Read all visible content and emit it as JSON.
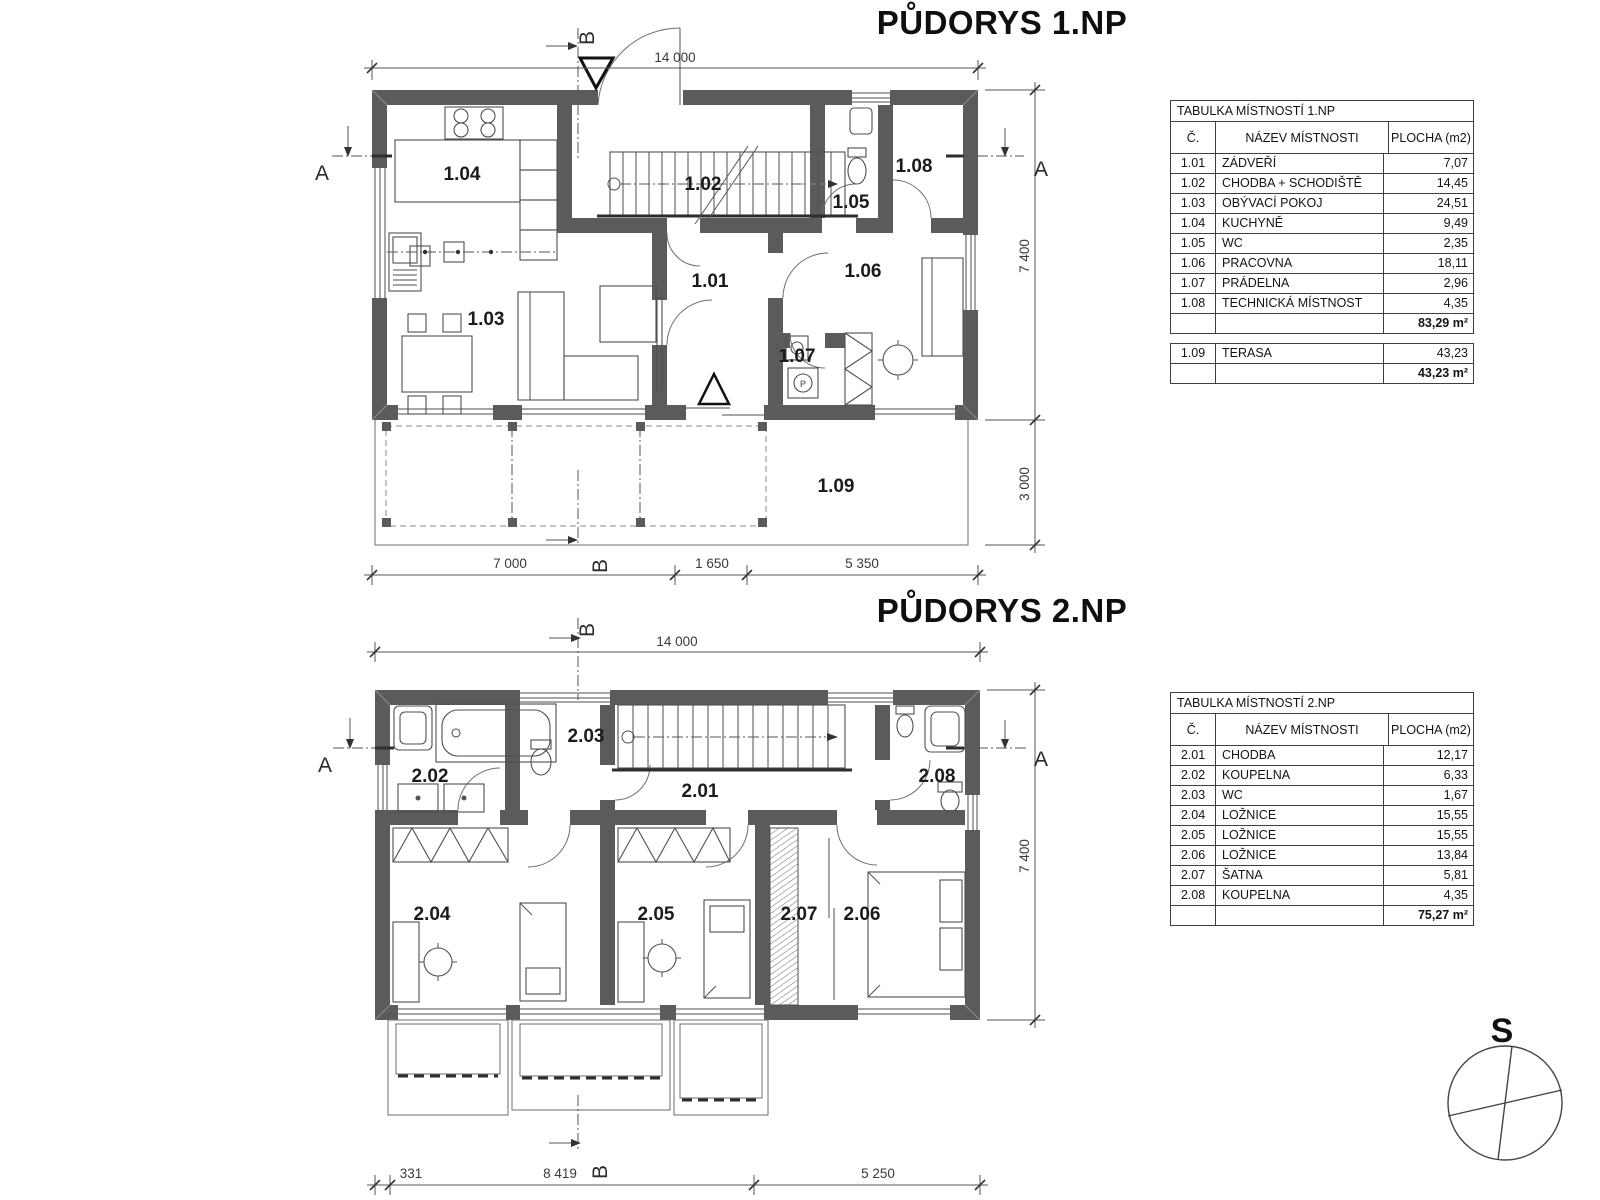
{
  "page": {
    "plan1_title": "PŮDORYS 1.NP",
    "plan2_title": "PŮDORYS 2.NP",
    "compass_label": "S"
  },
  "plan1": {
    "rooms": {
      "r101": "1.01",
      "r102": "1.02",
      "r103": "1.03",
      "r104": "1.04",
      "r105": "1.05",
      "r106": "1.06",
      "r107": "1.07",
      "r108": "1.08",
      "r109": "1.09"
    },
    "washer_label": "P",
    "dims": {
      "top": "14 000",
      "bottom": [
        "7 000",
        "1 650",
        "5 350"
      ],
      "right": [
        "7 400",
        "3 000"
      ]
    },
    "sections": {
      "a": "A",
      "b": "B"
    }
  },
  "plan2": {
    "rooms": {
      "r201": "2.01",
      "r202": "2.02",
      "r203": "2.03",
      "r204": "2.04",
      "r205": "2.05",
      "r206": "2.06",
      "r207": "2.07",
      "r208": "2.08"
    },
    "dims": {
      "top": "14 000",
      "bottom": [
        "331",
        "8 419",
        "5 250"
      ],
      "right": [
        "7 400"
      ]
    },
    "sections": {
      "a": "A",
      "b": "B"
    }
  },
  "table1": {
    "title": "TABULKA MÍSTNOSTÍ  1.NP",
    "headers": {
      "num": "Č.",
      "name": "NÁZEV MÍSTNOSTI",
      "area": "PLOCHA (m2)"
    },
    "rows": [
      {
        "num": "1.01",
        "name": "ZÁDVEŘÍ",
        "area": "7,07"
      },
      {
        "num": "1.02",
        "name": "CHODBA + SCHODIŠTĚ",
        "area": "14,45"
      },
      {
        "num": "1.03",
        "name": "OBÝVACÍ POKOJ",
        "area": "24,51"
      },
      {
        "num": "1.04",
        "name": "KUCHYNĚ",
        "area": "9,49"
      },
      {
        "num": "1.05",
        "name": "WC",
        "area": "2,35"
      },
      {
        "num": "1.06",
        "name": "PRACOVNA",
        "area": "18,11"
      },
      {
        "num": "1.07",
        "name": "PRÁDELNA",
        "area": "2,96"
      },
      {
        "num": "1.08",
        "name": "TECHNICKÁ MÍSTNOST",
        "area": "4,35"
      }
    ],
    "total": "83,29 m²"
  },
  "table1_extra": {
    "rows": [
      {
        "num": "1.09",
        "name": "TERASA",
        "area": "43,23"
      }
    ],
    "total": "43,23 m²"
  },
  "table2": {
    "title": "TABULKA MÍSTNOSTÍ 2.NP",
    "headers": {
      "num": "Č.",
      "name": "NÁZEV MÍSTNOSTI",
      "area": "PLOCHA (m2)"
    },
    "rows": [
      {
        "num": "2.01",
        "name": "CHODBA",
        "area": "12,17"
      },
      {
        "num": "2.02",
        "name": "KOUPELNA",
        "area": "6,33"
      },
      {
        "num": "2.03",
        "name": "WC",
        "area": "1,67"
      },
      {
        "num": "2.04",
        "name": "LOŽNICE",
        "area": "15,55"
      },
      {
        "num": "2.05",
        "name": "LOŽNICE",
        "area": "15,55"
      },
      {
        "num": "2.06",
        "name": "LOŽNICE",
        "area": "13,84"
      },
      {
        "num": "2.07",
        "name": "ŠATNA",
        "area": "5,81"
      },
      {
        "num": "2.08",
        "name": "KOUPELNA",
        "area": "4,35"
      }
    ],
    "total": "75,27 m²"
  },
  "colors": {
    "wall": "#5b5b5b",
    "line": "#4f4f4f",
    "text": "#1b1b1b"
  }
}
